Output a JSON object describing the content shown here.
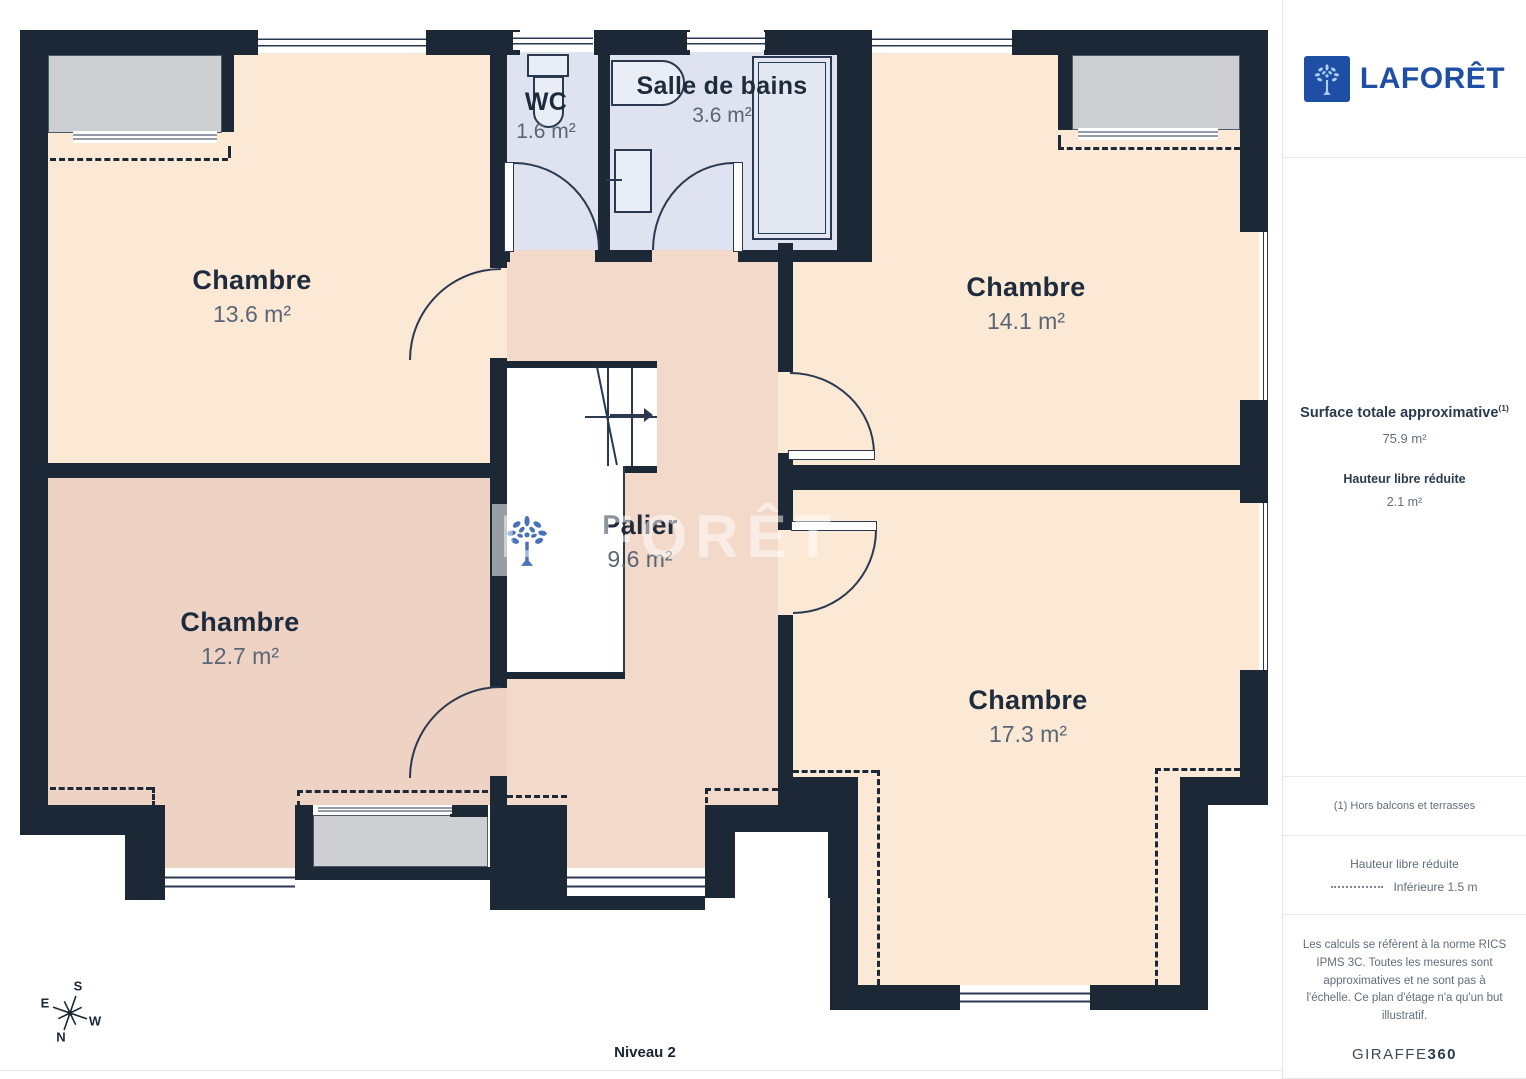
{
  "plan": {
    "level_label": "Niveau 2",
    "rooms": [
      {
        "name": "Chambre",
        "area": "13.6 m²"
      },
      {
        "name": "Chambre",
        "area": "14.1 m²"
      },
      {
        "name": "Chambre",
        "area": "12.7 m²"
      },
      {
        "name": "Chambre",
        "area": "17.3 m²"
      },
      {
        "name": "WC",
        "area": "1.6 m²"
      },
      {
        "name": "Salle de bains",
        "area": "3.6 m²"
      },
      {
        "name": "Palier",
        "area": "9.6 m²"
      }
    ],
    "compass": {
      "n": "N",
      "s": "S",
      "e": "E",
      "w": "W"
    },
    "colors": {
      "wall": "#1c2836",
      "bedroom_cream": "#fce9d5",
      "bedroom_rose": "#eed3c4",
      "bathroom_blue": "#dee3ef",
      "landing_pink": "#f2d9ca",
      "dormer_gray": "#cdcfd2"
    }
  },
  "watermark": {
    "text": "LAFORÊT"
  },
  "sidebar": {
    "brand": "LAFORÊT",
    "surface_title": "Surface totale approximative",
    "surface_note_ref": "(1)",
    "surface_value": "75.9 m²",
    "height_title": "Hauteur libre réduite",
    "height_value": "2.1 m²",
    "footnote": "(1) Hors balcons et terrasses",
    "legend_title": "Hauteur libre réduite",
    "legend_item": "Inférieure 1.5 m",
    "disclaimer": "Les calculs se réfèrent à la norme RICS IPMS 3C. Toutes les mesures sont approximatives et ne sont pas à l'échelle. Ce plan d'étage n'a qu'un but illustratif.",
    "credit_brand": "GIRAFFE",
    "credit_suffix": "360"
  }
}
